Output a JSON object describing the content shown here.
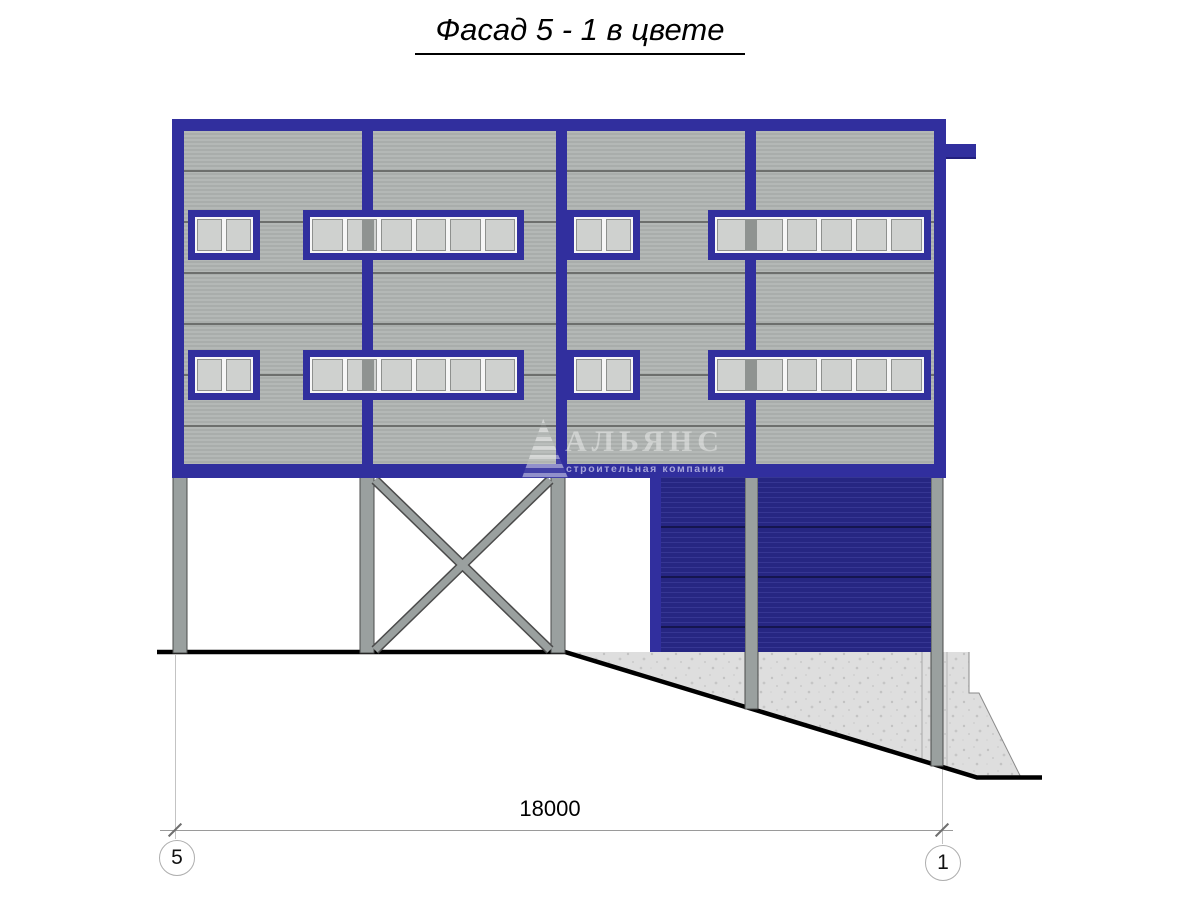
{
  "title": "Фасад 5 - 1 в цвете",
  "watermark": {
    "name": "АЛЬЯНС",
    "subtitle": "строительная компания"
  },
  "dimension": {
    "value": "18000",
    "axis_left": "5",
    "axis_right": "1"
  },
  "structure": {
    "window_rows": 2,
    "windows_per_row": [
      {
        "type": "small",
        "panes": 2
      },
      {
        "type": "long",
        "panes": 6
      },
      {
        "type": "small",
        "panes": 2
      },
      {
        "type": "long",
        "panes": 6
      }
    ],
    "garage_doors": 2,
    "garage_door_panels": 4,
    "support_columns": 5,
    "cross_braces": 1
  },
  "colors": {
    "frame_blue": "#312f9e",
    "door_blue": "#29298c",
    "siding_gray": "#aeb2b0",
    "column_gray": "#9aa09f",
    "concrete_gray": "#dedede",
    "glass_gray": "#cfd1cf",
    "ground_black": "#000000"
  }
}
